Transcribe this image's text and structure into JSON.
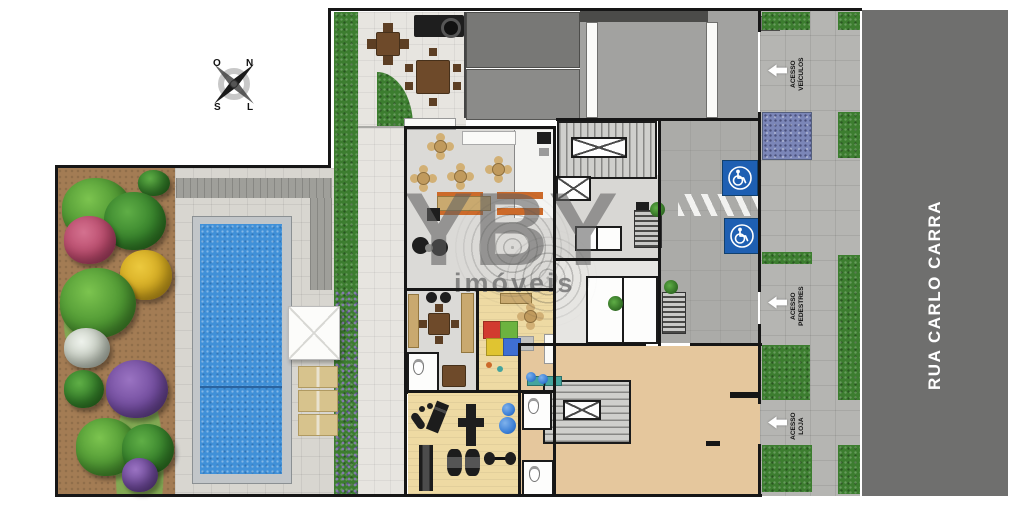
{
  "plan": {
    "road": {
      "name": "RUA CARLO CARRA"
    },
    "watermark": {
      "brand": "YBY",
      "tagline": "imóveis"
    },
    "compass": {
      "north": "N",
      "south": "S",
      "east": "L",
      "west": "O"
    },
    "accesses": [
      {
        "id": "vehicles",
        "line1": "ACESSO",
        "line2": "VEÍCULOS",
        "arrow_direction": "left"
      },
      {
        "id": "pedestrians",
        "line1": "ACESSO",
        "line2": "PEDESTRES",
        "arrow_direction": "left"
      },
      {
        "id": "shop",
        "line1": "ACESSO",
        "line2": "LOJA",
        "arrow_direction": "left"
      }
    ],
    "parking": {
      "accessible_icon": "wheelchair-icon",
      "accessible_spots": 2,
      "spot_color": "#1e5fb2"
    },
    "colors": {
      "road": "#6f6f6e",
      "sidewalk": "#b5b5b2",
      "pool_water": "#4090d8",
      "shop_floor": "#e5c79d",
      "hedge": "#3c7d2f",
      "soil": "#a37c54"
    }
  }
}
